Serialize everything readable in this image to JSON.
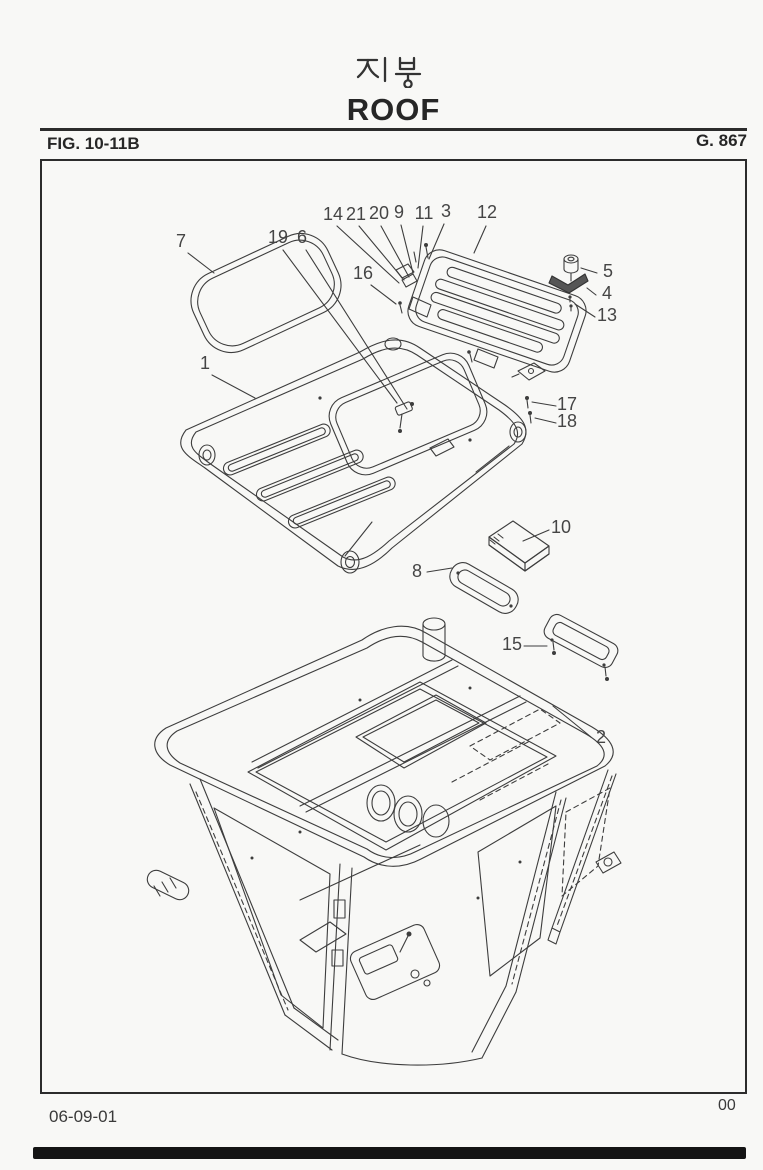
{
  "page": {
    "title_korean": "지붕",
    "title_english": "ROOF",
    "figure_label": "FIG. 10-11B",
    "group_code": "G. 867",
    "footer_date": "06-09-01",
    "footer_page_number": "00"
  },
  "diagram": {
    "type": "exploded-parts-diagram",
    "subject": "Cab roof assembly exploded view: seal ring, hatch cover with mounting hardware, roof panel with sunroof opening and ribs, pads, plates and cab frame",
    "callout_numbers": [
      "1",
      "2",
      "3",
      "4",
      "5",
      "6",
      "7",
      "8",
      "9",
      "10",
      "11",
      "12",
      "13",
      "14",
      "15",
      "16",
      "17",
      "18",
      "19",
      "20",
      "21"
    ],
    "labels": [
      {
        "text": "14",
        "x": 333,
        "y": 220
      },
      {
        "text": "21",
        "x": 356,
        "y": 220
      },
      {
        "text": "20",
        "x": 379,
        "y": 219
      },
      {
        "text": "9",
        "x": 399,
        "y": 218
      },
      {
        "text": "11",
        "x": 424,
        "y": 219
      },
      {
        "text": "3",
        "x": 446,
        "y": 217
      },
      {
        "text": "12",
        "x": 487,
        "y": 218
      },
      {
        "text": "7",
        "x": 181,
        "y": 247
      },
      {
        "text": "19",
        "x": 278,
        "y": 243
      },
      {
        "text": "6",
        "x": 302,
        "y": 243
      },
      {
        "text": "16",
        "x": 363,
        "y": 279
      },
      {
        "text": "5",
        "x": 608,
        "y": 277
      },
      {
        "text": "4",
        "x": 607,
        "y": 299
      },
      {
        "text": "13",
        "x": 607,
        "y": 321
      },
      {
        "text": "1",
        "x": 205,
        "y": 369
      },
      {
        "text": "17",
        "x": 567,
        "y": 410
      },
      {
        "text": "18",
        "x": 567,
        "y": 427
      },
      {
        "text": "10",
        "x": 561,
        "y": 533
      },
      {
        "text": "8",
        "x": 417,
        "y": 577
      },
      {
        "text": "15",
        "x": 512,
        "y": 650
      },
      {
        "text": "2",
        "x": 601,
        "y": 743
      }
    ]
  }
}
